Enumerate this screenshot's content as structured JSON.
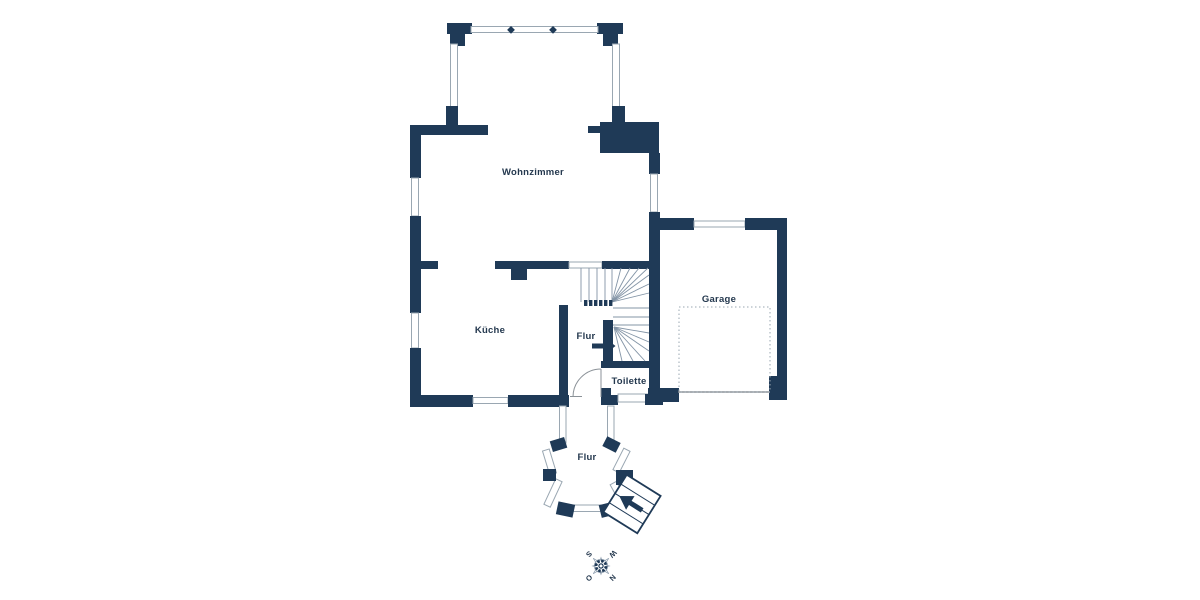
{
  "title": "Grundriss Erdgeschoss",
  "colors": {
    "wall": "#1f3a57",
    "win": "#9aa7b2",
    "stair": "#8394a6",
    "door": "#8b9298",
    "dotted": "#9aa7b2",
    "label": "#24384e"
  },
  "rooms": {
    "wohnzimmer": "Wohnzimmer",
    "kueche": "Küche",
    "flur": "Flur",
    "toilette": "Toilette",
    "garage": "Garage",
    "flur_entrance": "Flur"
  },
  "compass": {
    "north": "N",
    "east": "O",
    "south": "S",
    "west": "W"
  }
}
